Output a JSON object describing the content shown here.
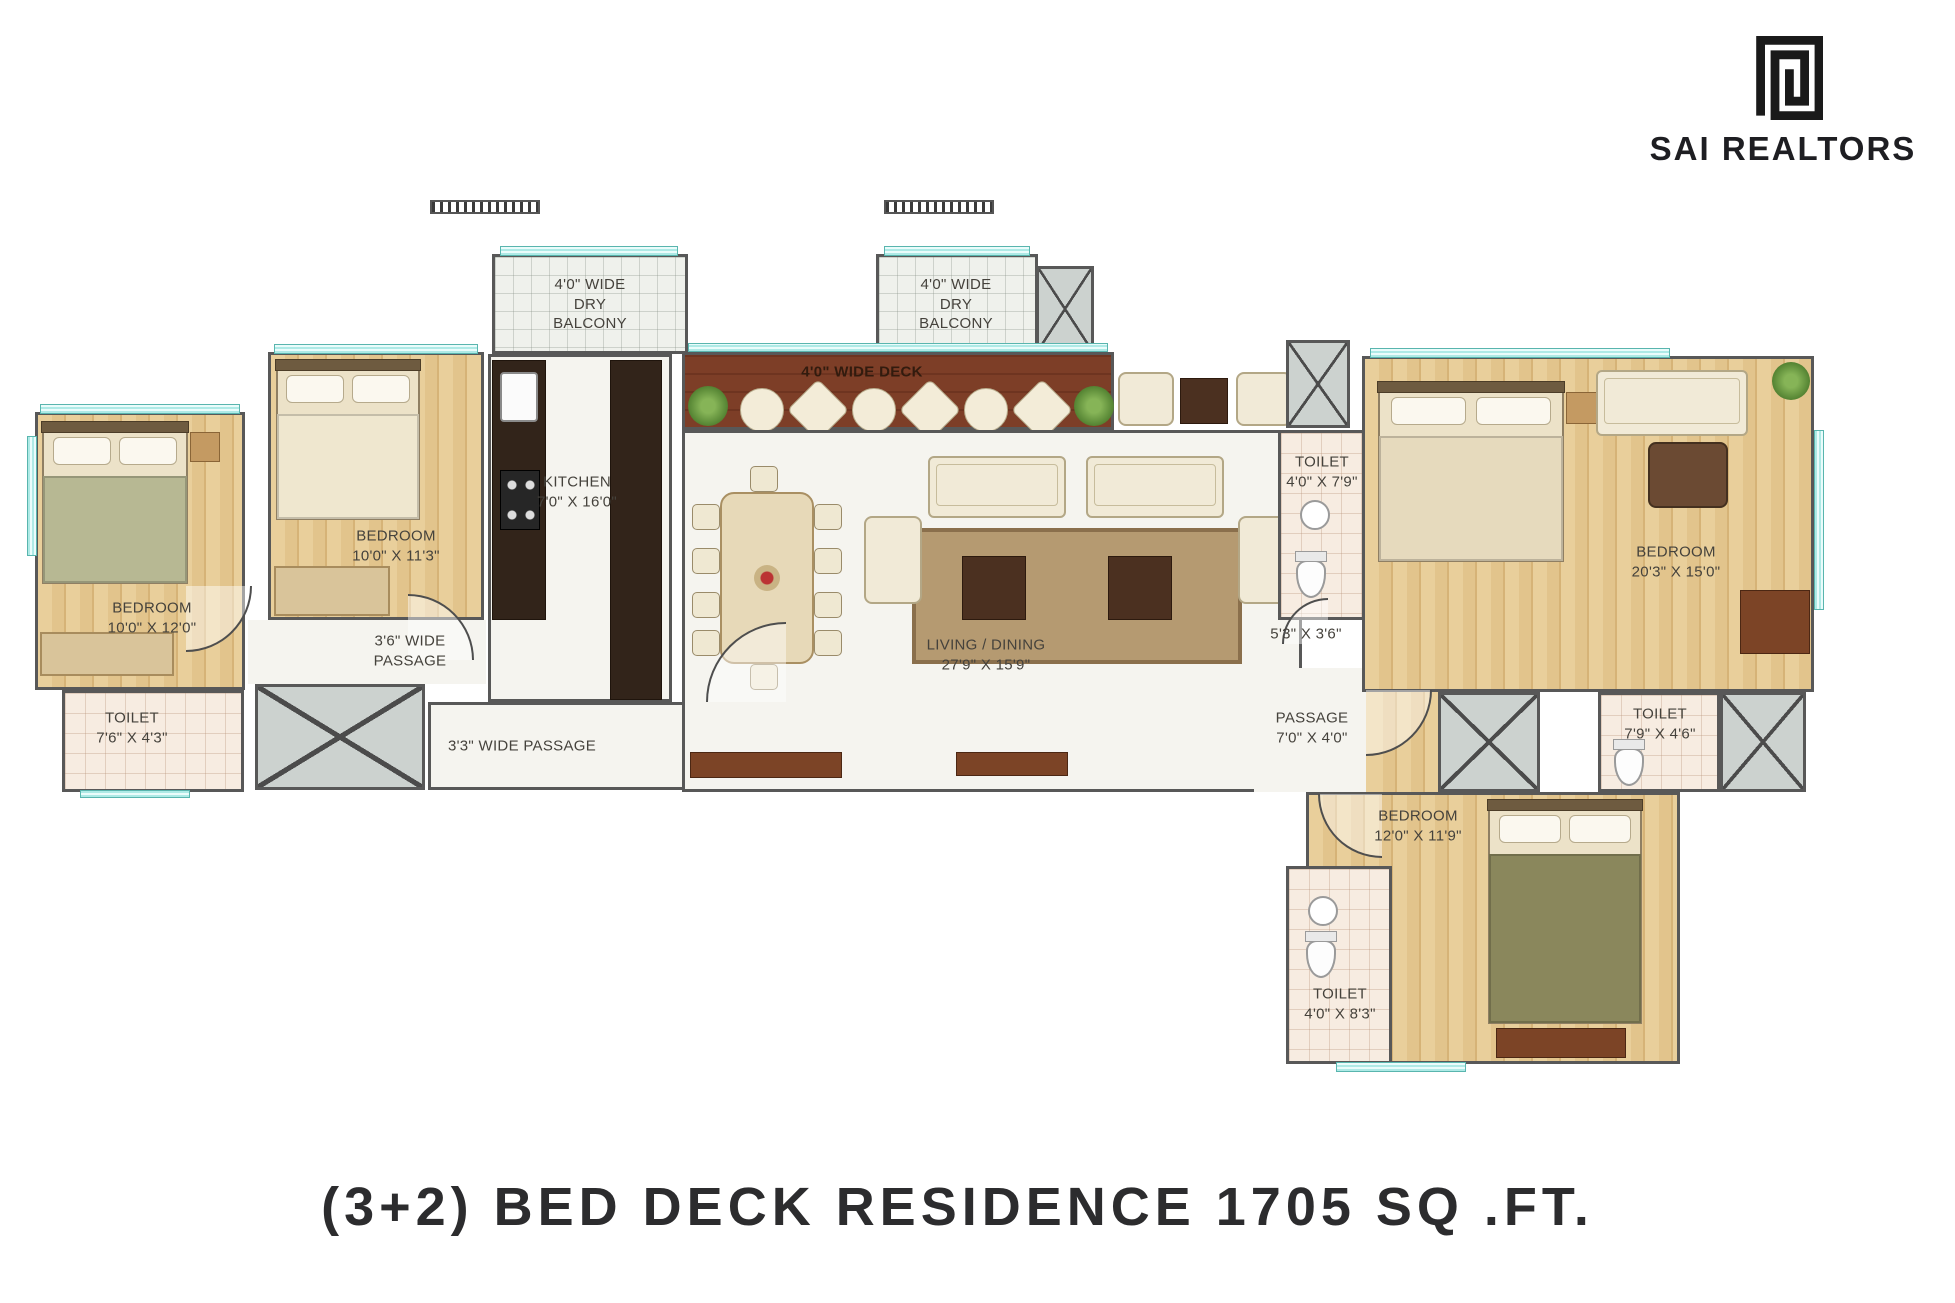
{
  "brand": {
    "name": "SAI REALTORS",
    "logo_icon": "square-spiral-logo"
  },
  "title": "(3+2) BED DECK RESIDENCE 1705 SQ .FT.",
  "colors": {
    "wall": "#585858",
    "wood_floor": "#e2c48c",
    "deck_wood": "#7d3e27",
    "window_glass": "#aeeae6",
    "tile_floor": "#f7ece1",
    "title_text": "#2c2c2e",
    "logo_black": "#1a1a1a"
  },
  "labels": {
    "dry_balcony_left": "4'0\" WIDE\nDRY\nBALCONY",
    "dry_balcony_right": "4'0\" WIDE\nDRY\nBALCONY",
    "deck": "4'0\" WIDE DECK",
    "kitchen": "KITCHEN\n7'0\" X 16'0\"",
    "bedroom_left": "BEDROOM\n10'0\" X 12'0\"",
    "bedroom_mid": "BEDROOM\n10'0\" X 11'3\"",
    "toilet_left": "TOILET\n7'6\" X 4'3\"",
    "passage_36": "3'6\" WIDE\nPASSAGE",
    "passage_33": "3'3\" WIDE PASSAGE",
    "living_dining": "LIVING / DINING\n27'9\" X 15'9\"",
    "toilet_master": "TOILET\n4'0\" X 7'9\"",
    "niche": "5'3\" X 3'6\"",
    "passage_right": "PASSAGE\n7'0\" X 4'0\"",
    "bedroom_master": "BEDROOM\n20'3\" X 15'0\"",
    "toilet_right": "TOILET\n7'9\" X 4'6\"",
    "bedroom_bottom": "BEDROOM\n12'0\" X 11'9\"",
    "toilet_bottom": "TOILET\n4'0\" X 8'3\""
  }
}
